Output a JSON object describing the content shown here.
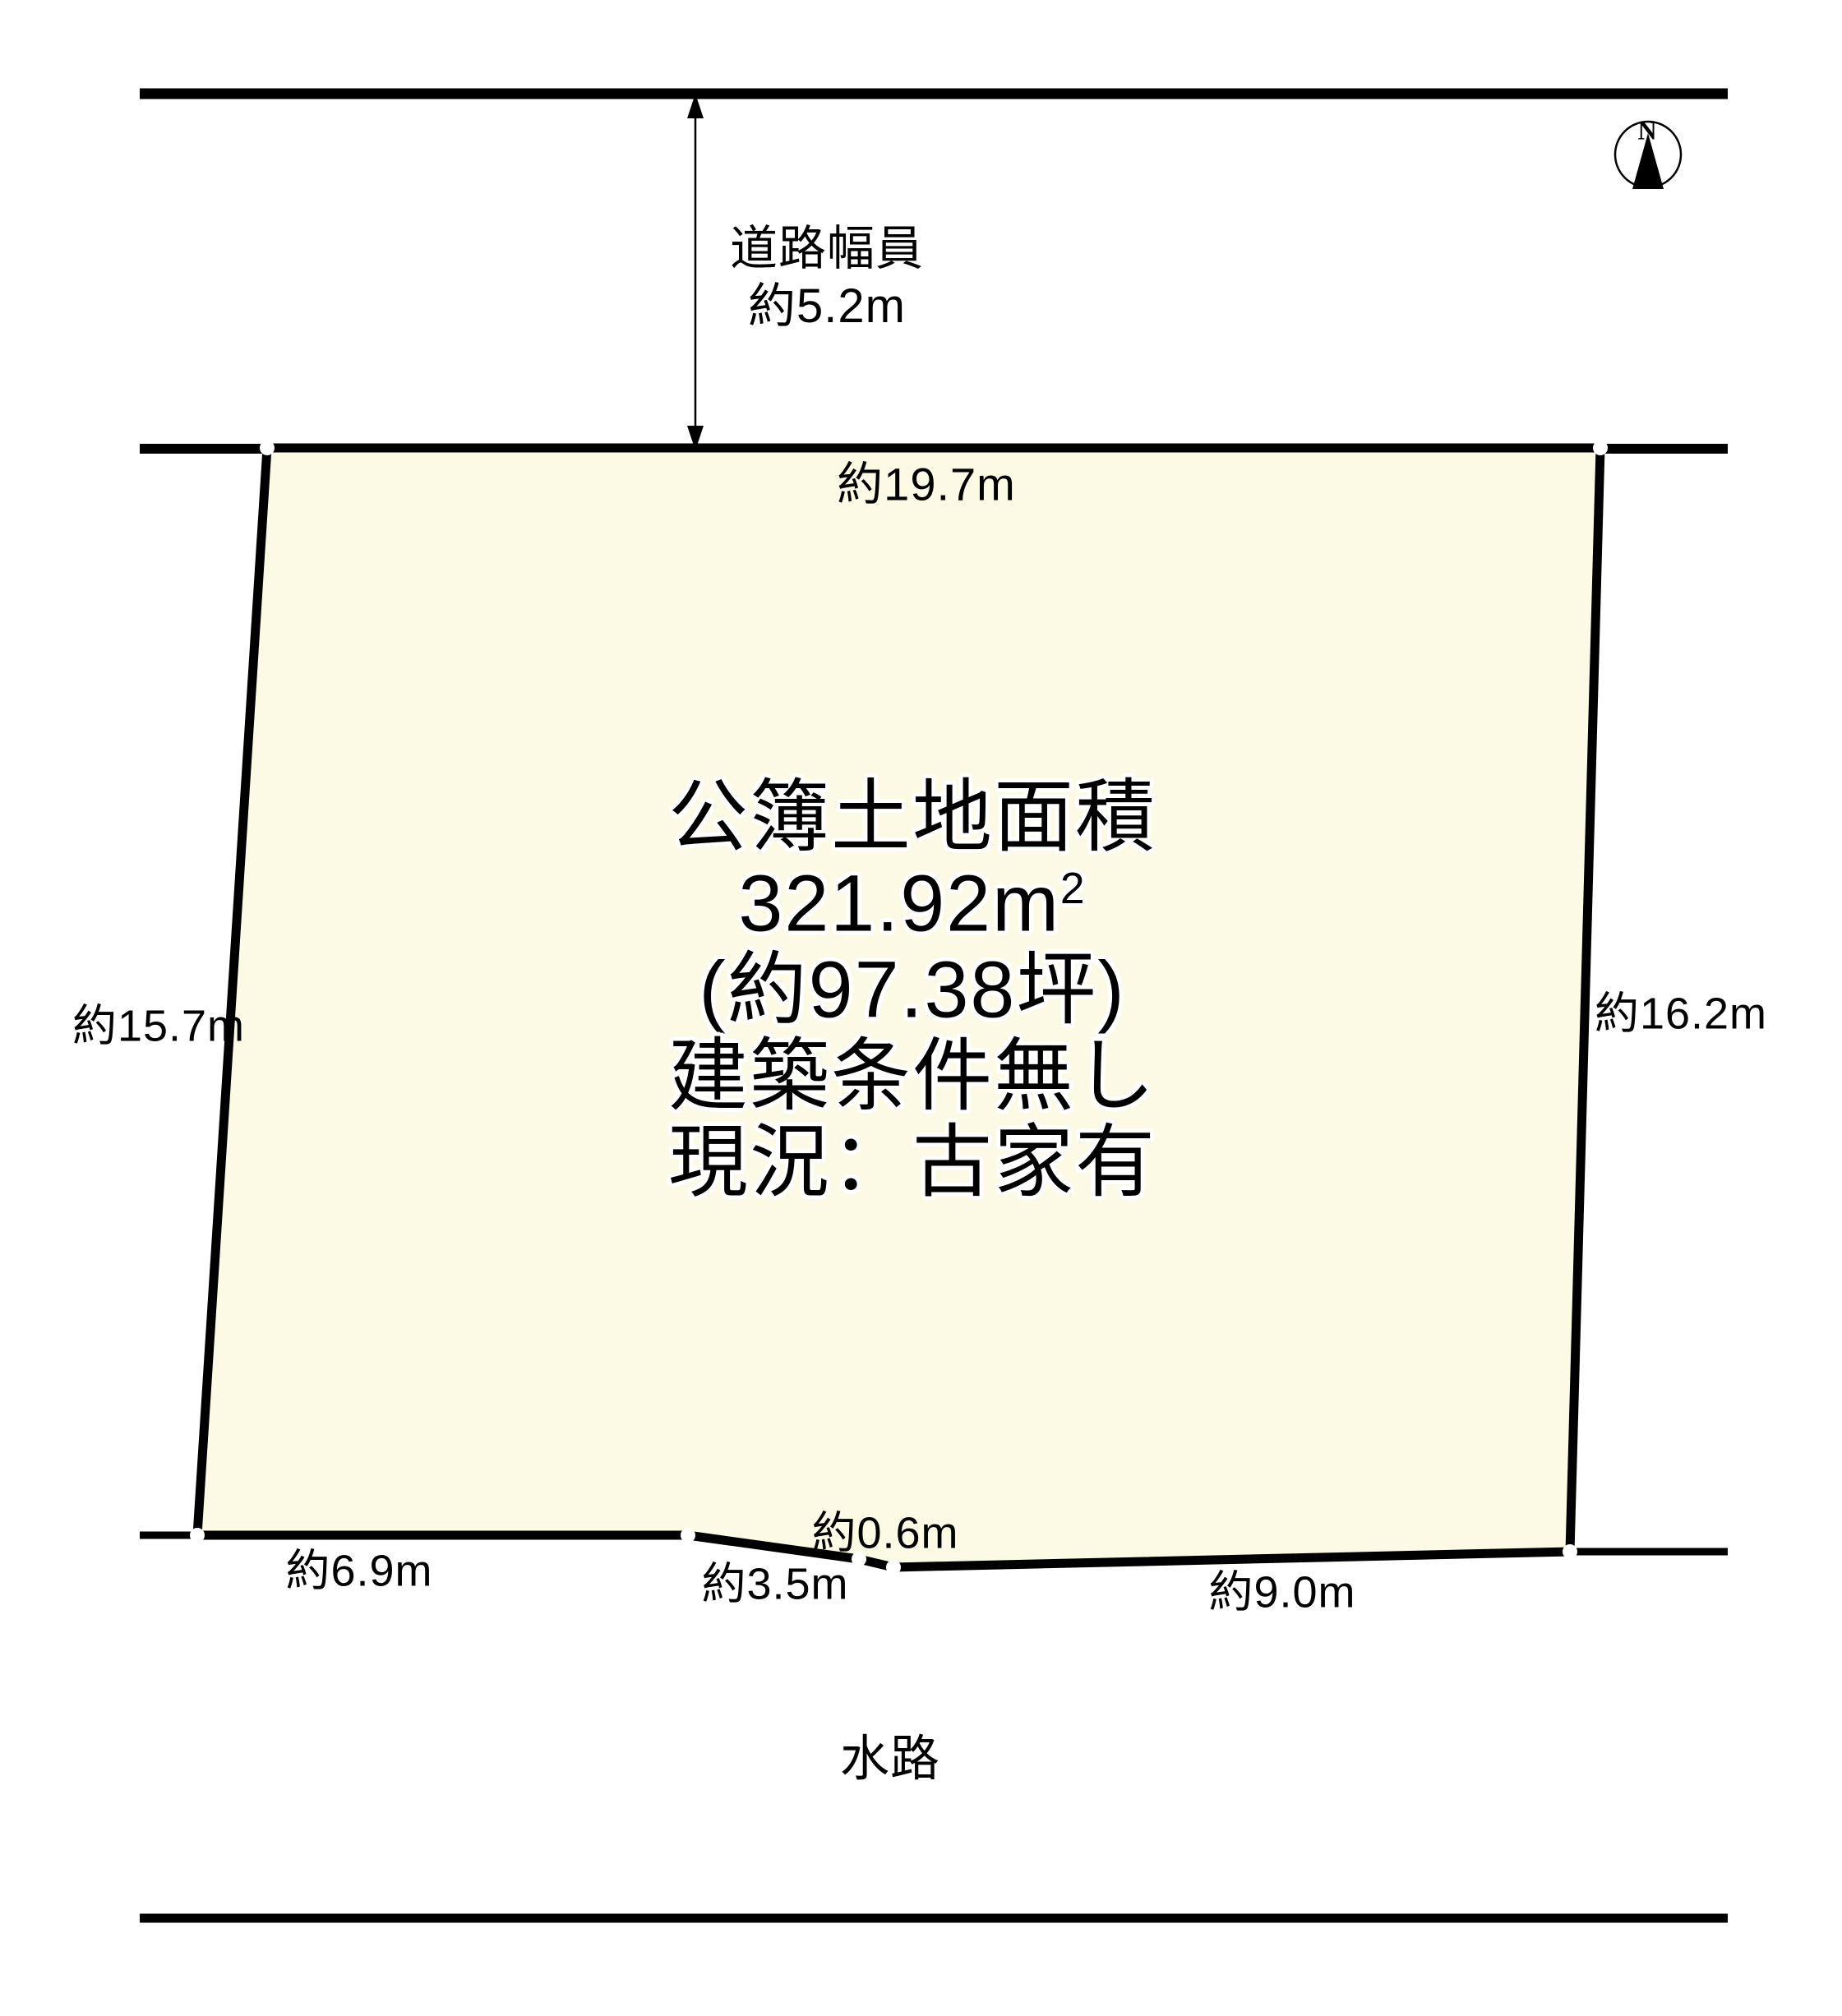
{
  "diagram": {
    "compass": {
      "label": "N"
    },
    "road": {
      "label_line1": "道路幅員",
      "label_line2": "約5.2m"
    },
    "parcel": {
      "area_title": "公簿土地面積",
      "area_value": "321.92m",
      "area_sup": "2",
      "area_tsubo": "(約97.38坪)",
      "condition": "建築条件無し",
      "status": "現況：古家有",
      "fill_color": "#FCF9E4"
    },
    "measurements": {
      "top": "約19.7m",
      "left": "約15.7m",
      "right": "約16.2m",
      "bottom_left": "約6.9m",
      "bottom_mid": "約3.5m",
      "bottom_notch": "約0.6m",
      "bottom_right": "約9.0m"
    },
    "waterway_label": "水路"
  }
}
